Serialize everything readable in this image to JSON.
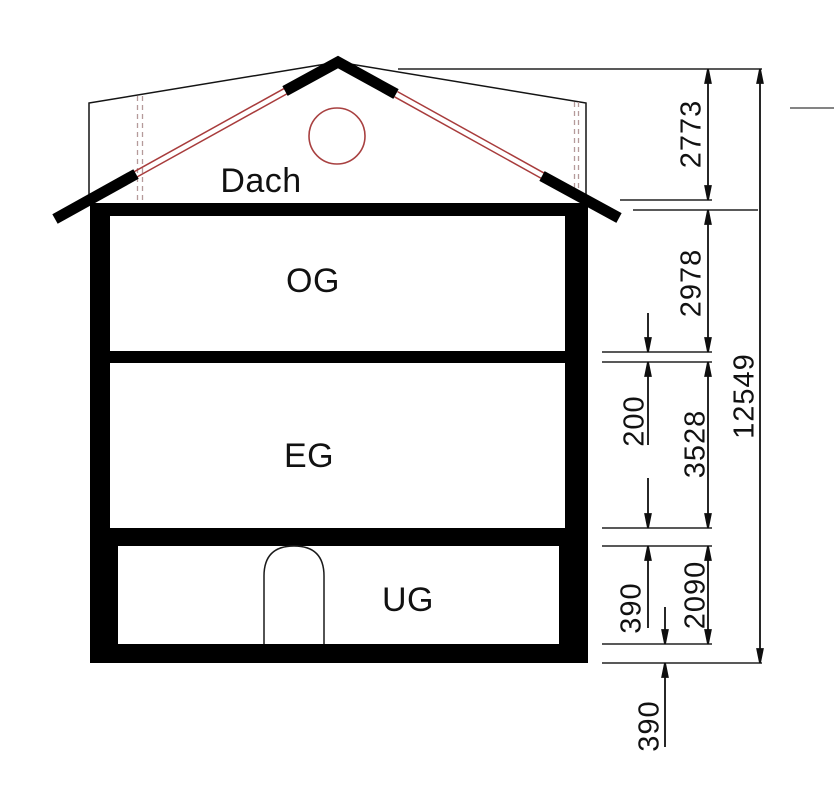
{
  "rooms": {
    "dach": "Dach",
    "og": "OG",
    "eg": "EG",
    "ug": "UG"
  },
  "dimensions": {
    "roof_height": "2773",
    "og_height": "2978",
    "og_slab_thickness": "200",
    "eg_height": "3528",
    "eg_slab_thickness": "390",
    "ug_height": "2090",
    "ug_slab_thickness": "390",
    "total_height": "12549"
  },
  "colors": {
    "line_black": "#141414",
    "roof_red": "#a83c3c",
    "circle_red": "#a84040",
    "dashed_hidden": "#b59a9a",
    "stray_gray": "#848484"
  }
}
